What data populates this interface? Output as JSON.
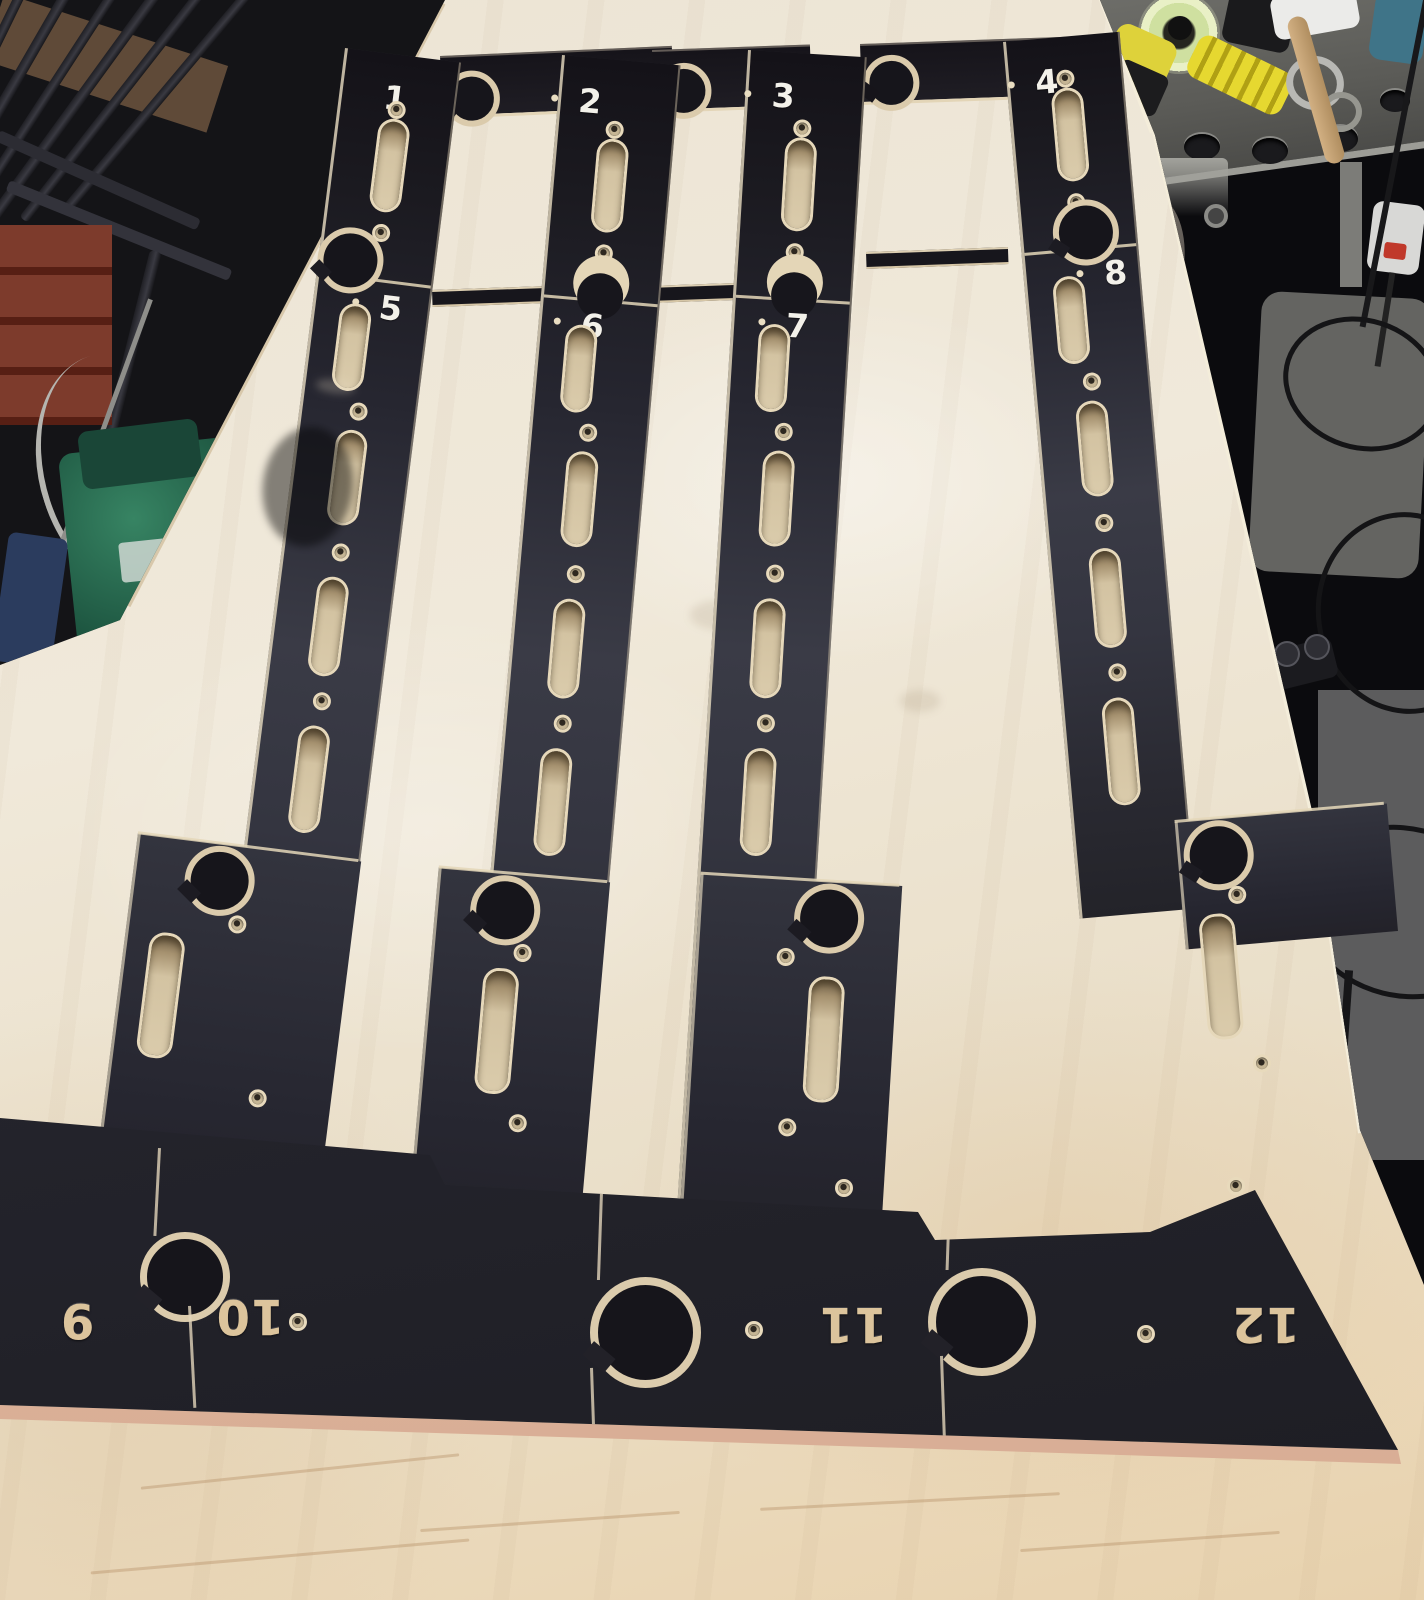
{
  "image_type": "photograph",
  "scene": {
    "setting": "woodworking workshop",
    "subject": "twelve numbered CNC-cut black laminated plywood template parts laid out on a birch plywood workbench",
    "bottom_numbers_orientation": "rotated 180 degrees, engraved showing raw wood"
  },
  "board": {
    "pieces": [
      {
        "label": "1"
      },
      {
        "label": "2"
      },
      {
        "label": "3"
      },
      {
        "label": "4"
      },
      {
        "label": "5"
      },
      {
        "label": "6"
      },
      {
        "label": "7"
      },
      {
        "label": "8"
      },
      {
        "label": "9"
      },
      {
        "label": "10"
      },
      {
        "label": "11"
      },
      {
        "label": "12"
      }
    ]
  },
  "colors": {
    "table_plywood": "#ece4d0",
    "template_black": "#25242b",
    "plywood_edge": "#e2d3b2",
    "slot_wood": "#d3c3a2",
    "engraved_number": "#dcc49c",
    "printed_number": "#f3f1ea",
    "tool_yellow": "#e0d334",
    "tape_ring": "#d6e4a2",
    "brick_red": "#7d3b2c",
    "machine_green": "#2f7a5c",
    "floor_gray": "#646461",
    "bench_gray": "#5b5b57"
  },
  "background": {
    "items": [
      "clamp-rack",
      "wooden-shelf",
      "brick-wall-patch",
      "green-machine",
      "blue-container",
      "white-cable",
      "welding-table",
      "tape-dispenser",
      "clear-tape-roll",
      "yellow-tape-gun",
      "black-pliers",
      "metal-rings",
      "white-mallet-head",
      "wooden-handle",
      "blue-cloth",
      "mounting-bracket",
      "hanging-rag",
      "table-leg",
      "power-plug",
      "red-switch",
      "power-strip",
      "cable-loops",
      "concrete-floor"
    ]
  }
}
